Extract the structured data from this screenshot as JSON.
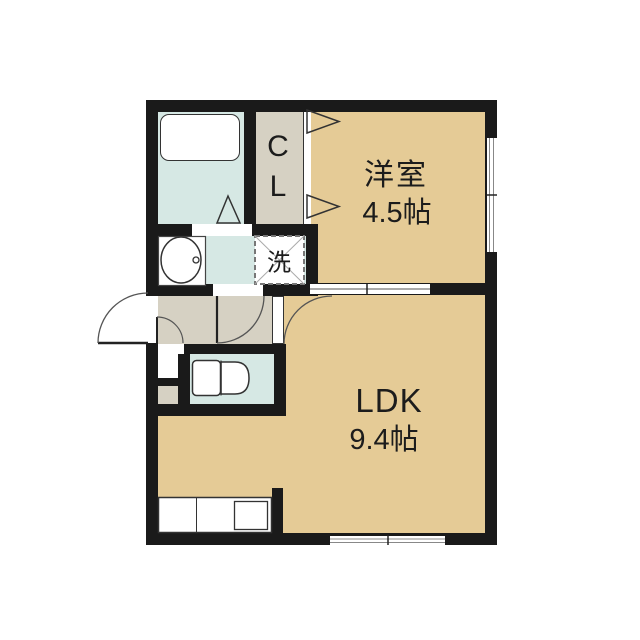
{
  "plan": {
    "type": "apartment-floor-plan",
    "rooms": {
      "western": {
        "label": "洋室",
        "area": "4.5帖"
      },
      "ldk": {
        "label": "LDK",
        "area": "9.4帖"
      },
      "closet": {
        "line1": "C",
        "line2": "L"
      },
      "laundry": {
        "label": "洗"
      }
    },
    "fixtures": [
      "bathtub",
      "washbasin",
      "washing-machine-pan",
      "toilet",
      "kitchen-counter",
      "kitchen-sink",
      "entrance-door",
      "folding-doors",
      "windows"
    ]
  },
  "colors": {
    "room": "#e5cb96",
    "wet": "#d6e8e4",
    "hall": "#d6d1c3",
    "wall": "#1a1a1a"
  }
}
